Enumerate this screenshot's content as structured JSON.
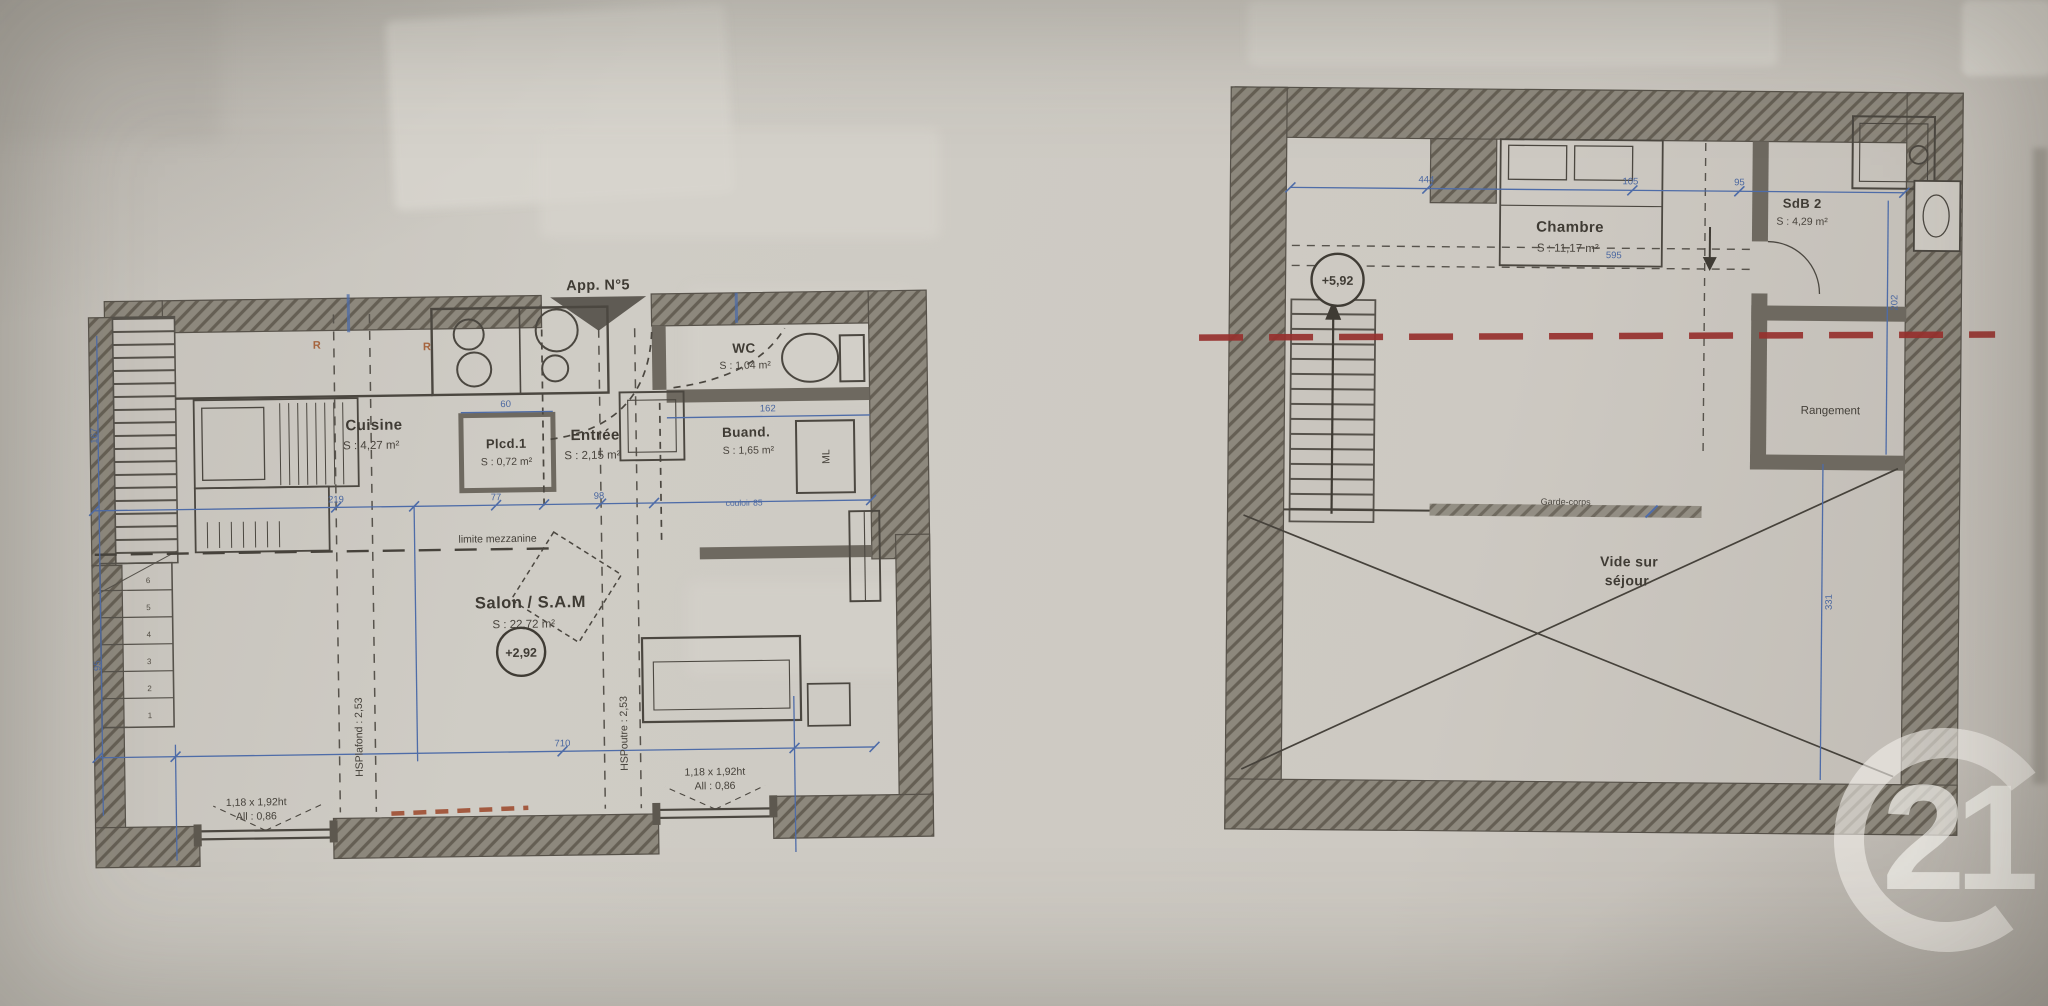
{
  "watermark": {
    "number": "21"
  },
  "left_plan": {
    "title": "App. N°5",
    "rooms": {
      "cuisine": {
        "name": "Cuisine",
        "area": "S : 4,27 m²"
      },
      "placard": {
        "name": "Plcd.1",
        "area": "S : 0,72 m²"
      },
      "entree": {
        "name": "Entrée",
        "area": "S : 2,15 m²"
      },
      "wc": {
        "name": "WC",
        "area": "S : 1,04 m²"
      },
      "buanderie": {
        "name": "Buand.",
        "area": "S : 1,65 m²"
      },
      "salon": {
        "name": "Salon / S.A.M",
        "area": "S : 22,72 m²",
        "level": "+2,92"
      }
    },
    "annotations": {
      "mezzanine_limit": "limite mezzanine",
      "hsp_left": "HSPlafond : 2,53",
      "hsp_right": "HSPoutre : 2,53",
      "ml": "ML",
      "r_mark_1": "R",
      "r_mark_2": "R",
      "window_size": "1,18 x 1,92ht",
      "window_allege": "All : 0,86"
    },
    "stair_numbers": [
      "6",
      "5",
      "4",
      "3",
      "2",
      "1"
    ],
    "dims": {
      "w219": "219",
      "w77": "77",
      "w98": "98",
      "w60": "60",
      "w162": "162",
      "w710": "710",
      "h167": "167",
      "h95": "95",
      "note": "couloir 85"
    }
  },
  "right_plan": {
    "rooms": {
      "chambre": {
        "name": "Chambre",
        "area": "S : 11,17 m²"
      },
      "sdb": {
        "name": "SdB 2",
        "area": "S : 4,29 m²"
      },
      "rangement": {
        "name": "Rangement"
      },
      "vide": {
        "line1": "Vide sur",
        "line2": "séjour"
      }
    },
    "annotations": {
      "garde_corps": "Garde-corps",
      "level": "+5,92"
    },
    "dims": {
      "w444": "444",
      "w105": "105",
      "w95": "95",
      "w595": "595",
      "h202": "202",
      "h331": "331"
    }
  }
}
